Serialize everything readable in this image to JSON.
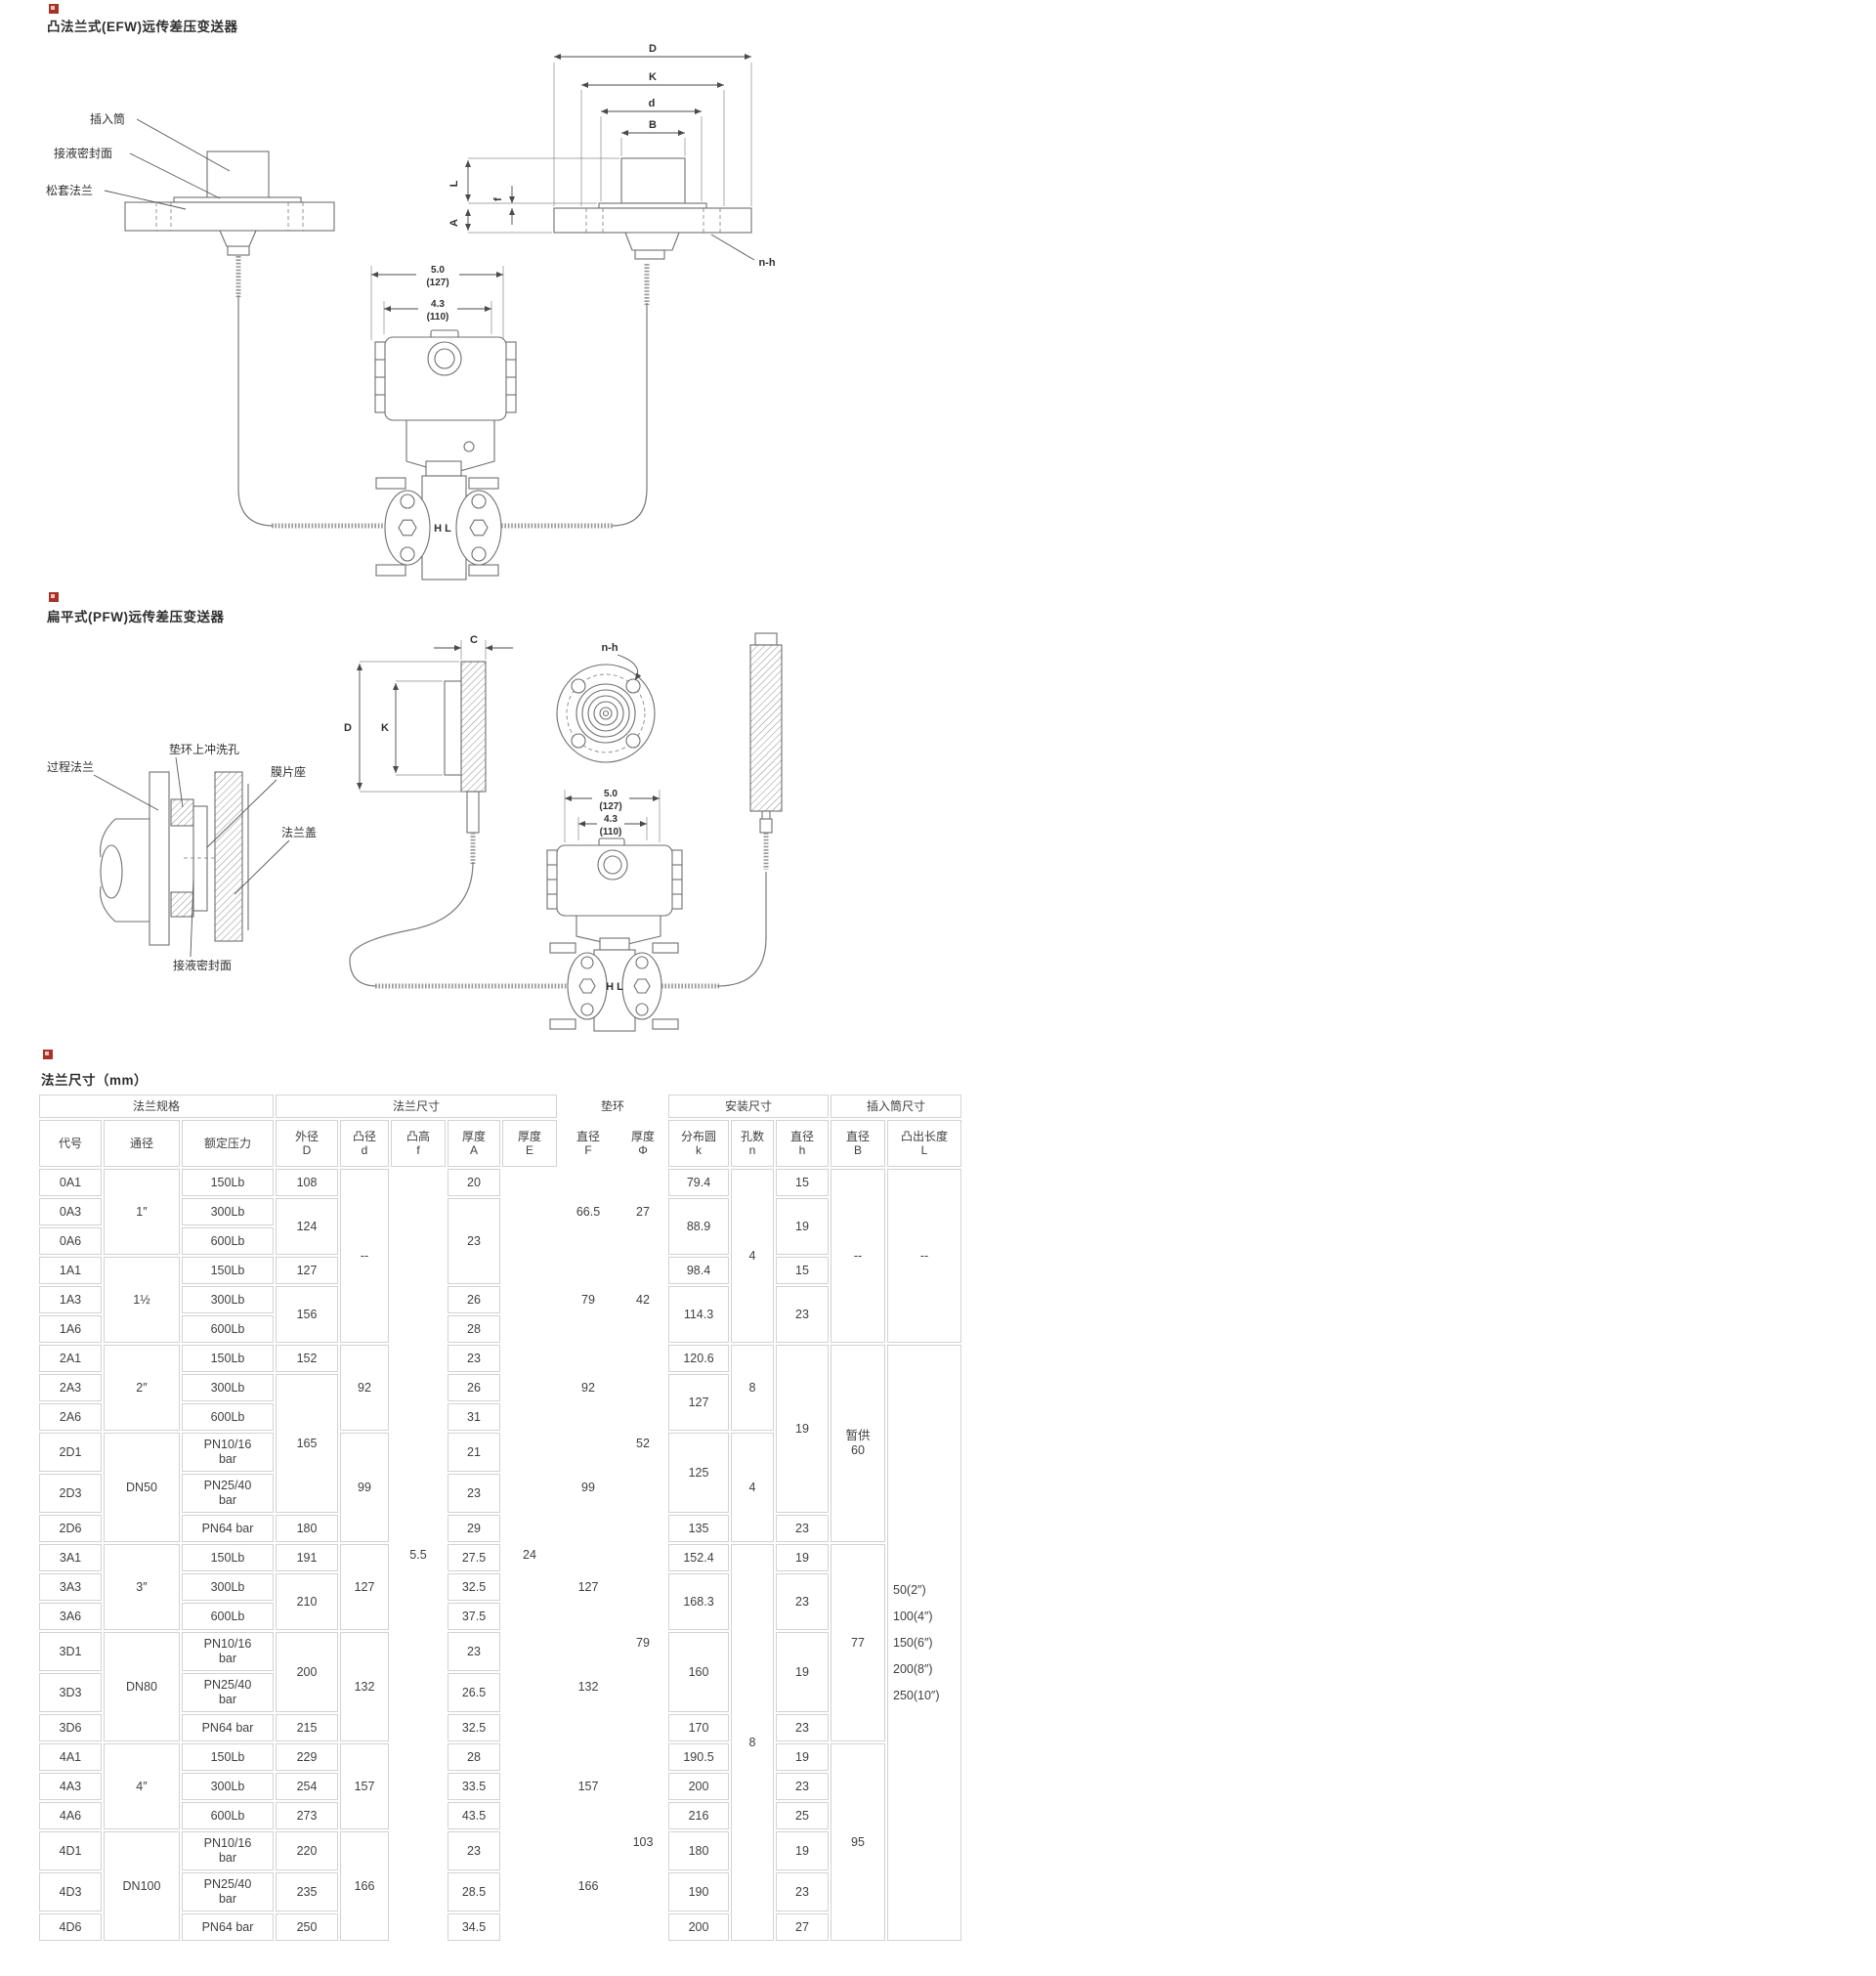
{
  "diagram_efw": {
    "title": "凸法兰式(EFW)远传差压变送器",
    "labels": {
      "insert_tube": "插入筒",
      "wetted_seal_face": "接液密封面",
      "loose_flange": "松套法兰",
      "nh": "n-h",
      "hl": "H L"
    },
    "dims": {
      "D": "D",
      "K": "K",
      "d": "d",
      "B": "B",
      "L": "L",
      "A": "A",
      "f": "f"
    },
    "w": {
      "w1": "5.0",
      "w1p": "(127)",
      "w2": "4.3",
      "w2p": "(110)"
    }
  },
  "diagram_pfw": {
    "title": "扁平式(PFW)远传差压变送器",
    "labels": {
      "process_flange": "过程法兰",
      "flush_hole": "垫环上冲洗孔",
      "diaphragm_seat": "膜片座",
      "flange_cover": "法兰盖",
      "wetted_seal_face": "接液密封面",
      "nh": "n-h",
      "hl": "H L"
    },
    "dims": {
      "C": "C",
      "D": "D",
      "K": "K"
    },
    "w": {
      "w1": "5.0",
      "w1p": "(127)",
      "w2": "4.3",
      "w2p": "(110)"
    }
  },
  "table": {
    "title": "法兰尺寸（mm）",
    "groups": [
      {
        "label": "法兰规格",
        "span": 3
      },
      {
        "label": "法兰尺寸",
        "span": 5
      },
      {
        "label": "垫环",
        "span": 2,
        "nb": true
      },
      {
        "label": "安装尺寸",
        "span": 3
      },
      {
        "label": "插入筒尺寸",
        "span": 2
      }
    ],
    "headers": [
      {
        "t": "代号"
      },
      {
        "t": "通径"
      },
      {
        "t": "额定压力"
      },
      {
        "t": "外径\nD"
      },
      {
        "t": "凸径\nd"
      },
      {
        "t": "凸高\nf"
      },
      {
        "t": "厚度\nA"
      },
      {
        "t": "厚度\nE"
      },
      {
        "t": "直径\nF",
        "nb": true
      },
      {
        "t": "厚度\nΦ",
        "nb": true
      },
      {
        "t": "分布圆\nk"
      },
      {
        "t": "孔数\nn"
      },
      {
        "t": "直径\nh"
      },
      {
        "t": "直径\nB"
      },
      {
        "t": "凸出长度\nL"
      }
    ],
    "body": [
      {
        "cells": [
          {
            "t": "0A1"
          },
          {
            "t": "1″",
            "rs": 3
          },
          {
            "t": "150Lb"
          },
          {
            "t": "108"
          },
          {
            "t": "--",
            "rs": 6
          },
          {
            "t": "5.5",
            "rs": 24,
            "nb": true
          },
          {
            "t": "20"
          },
          {
            "t": "24",
            "rs": 24,
            "nb": true
          },
          {
            "t": "66.5",
            "rs": 3,
            "nb": true
          },
          {
            "t": "27",
            "rs": 3,
            "nb": true
          },
          {
            "t": "79.4"
          },
          {
            "t": "4",
            "rs": 6
          },
          {
            "t": "15"
          },
          {
            "t": "--",
            "rs": 6
          },
          {
            "t": "--",
            "rs": 6
          }
        ]
      },
      {
        "cells": [
          {
            "t": "0A3"
          },
          {
            "t": "300Lb"
          },
          {
            "t": "124",
            "rs": 2
          },
          {
            "t": "23",
            "rs": 3
          },
          {
            "t": "88.9",
            "rs": 2
          },
          {
            "t": "19",
            "rs": 2
          }
        ]
      },
      {
        "cells": [
          {
            "t": "0A6"
          },
          {
            "t": "600Lb"
          }
        ]
      },
      {
        "cells": [
          {
            "t": "1A1"
          },
          {
            "t": "1½",
            "rs": 3
          },
          {
            "t": "150Lb"
          },
          {
            "t": "127"
          },
          {
            "t": "79",
            "rs": 3,
            "nb": true
          },
          {
            "t": "42",
            "rs": 3,
            "nb": true
          },
          {
            "t": "98.4"
          },
          {
            "t": "15"
          }
        ]
      },
      {
        "cells": [
          {
            "t": "1A3"
          },
          {
            "t": "300Lb"
          },
          {
            "t": "156",
            "rs": 2
          },
          {
            "t": "26"
          },
          {
            "t": "114.3",
            "rs": 2
          },
          {
            "t": "23",
            "rs": 2
          }
        ]
      },
      {
        "cells": [
          {
            "t": "1A6"
          },
          {
            "t": "600Lb"
          },
          {
            "t": "28"
          }
        ]
      },
      {
        "cells": [
          {
            "t": "2A1"
          },
          {
            "t": "2″",
            "rs": 3
          },
          {
            "t": "150Lb"
          },
          {
            "t": "152"
          },
          {
            "t": "92",
            "rs": 3
          },
          {
            "t": "23"
          },
          {
            "t": "92",
            "rs": 3,
            "nb": true
          },
          {
            "t": "52",
            "rs": 6,
            "nb": true
          },
          {
            "t": "120.6"
          },
          {
            "t": "8",
            "rs": 3
          },
          {
            "t": "19",
            "rs": 5
          },
          {
            "t": "暂供\n60",
            "rs": 6
          },
          {
            "t": "50(2″)\n100(4″)\n150(6″)\n200(8″)\n250(10″)",
            "rs": 18,
            "al": true
          }
        ]
      },
      {
        "cells": [
          {
            "t": "2A3"
          },
          {
            "t": "300Lb"
          },
          {
            "t": "165",
            "rs": 4
          },
          {
            "t": "26"
          },
          {
            "t": "127",
            "rs": 2
          }
        ]
      },
      {
        "cells": [
          {
            "t": "2A6"
          },
          {
            "t": "600Lb"
          },
          {
            "t": "31"
          }
        ]
      },
      {
        "tall": true,
        "cells": [
          {
            "t": "2D1"
          },
          {
            "t": "DN50",
            "rs": 3
          },
          {
            "t": "PN10/16\nbar"
          },
          {
            "t": "99",
            "rs": 3
          },
          {
            "t": "21"
          },
          {
            "t": "99",
            "rs": 3,
            "nb": true
          },
          {
            "t": "125",
            "rs": 2
          },
          {
            "t": "4",
            "rs": 3
          }
        ]
      },
      {
        "tall": true,
        "cells": [
          {
            "t": "2D3"
          },
          {
            "t": "PN25/40\nbar"
          },
          {
            "t": "23"
          }
        ]
      },
      {
        "cells": [
          {
            "t": "2D6"
          },
          {
            "t": "PN64 bar"
          },
          {
            "t": "180"
          },
          {
            "t": "29"
          },
          {
            "t": "135"
          },
          {
            "t": "23"
          }
        ]
      },
      {
        "cells": [
          {
            "t": "3A1"
          },
          {
            "t": "3″",
            "rs": 3
          },
          {
            "t": "150Lb"
          },
          {
            "t": "191"
          },
          {
            "t": "127",
            "rs": 3
          },
          {
            "t": "27.5"
          },
          {
            "t": "127",
            "rs": 3,
            "nb": true
          },
          {
            "t": "79",
            "rs": 6,
            "nb": true
          },
          {
            "t": "152.4"
          },
          {
            "t": "8",
            "rs": 12
          },
          {
            "t": "19"
          },
          {
            "t": "77",
            "rs": 6
          }
        ]
      },
      {
        "cells": [
          {
            "t": "3A3"
          },
          {
            "t": "300Lb"
          },
          {
            "t": "210",
            "rs": 2
          },
          {
            "t": "32.5"
          },
          {
            "t": "168.3",
            "rs": 2
          },
          {
            "t": "23",
            "rs": 2
          }
        ]
      },
      {
        "cells": [
          {
            "t": "3A6"
          },
          {
            "t": "600Lb"
          },
          {
            "t": "37.5"
          }
        ]
      },
      {
        "tall": true,
        "cells": [
          {
            "t": "3D1"
          },
          {
            "t": "DN80",
            "rs": 3
          },
          {
            "t": "PN10/16\nbar"
          },
          {
            "t": "200",
            "rs": 2
          },
          {
            "t": "132",
            "rs": 3
          },
          {
            "t": "23"
          },
          {
            "t": "132",
            "rs": 3,
            "nb": true
          },
          {
            "t": "160",
            "rs": 2
          },
          {
            "t": "19",
            "rs": 2
          }
        ]
      },
      {
        "tall": true,
        "cells": [
          {
            "t": "3D3"
          },
          {
            "t": "PN25/40\nbar"
          },
          {
            "t": "26.5"
          }
        ]
      },
      {
        "cells": [
          {
            "t": "3D6"
          },
          {
            "t": "PN64 bar"
          },
          {
            "t": "215"
          },
          {
            "t": "32.5"
          },
          {
            "t": "170"
          },
          {
            "t": "23"
          }
        ]
      },
      {
        "cells": [
          {
            "t": "4A1"
          },
          {
            "t": "4″",
            "rs": 3
          },
          {
            "t": "150Lb"
          },
          {
            "t": "229"
          },
          {
            "t": "157",
            "rs": 3
          },
          {
            "t": "28"
          },
          {
            "t": "157",
            "rs": 3,
            "nb": true
          },
          {
            "t": "103",
            "rs": 6,
            "nb": true
          },
          {
            "t": "190.5"
          },
          {
            "t": "19"
          },
          {
            "t": "95",
            "rs": 6
          }
        ]
      },
      {
        "cells": [
          {
            "t": "4A3"
          },
          {
            "t": "300Lb"
          },
          {
            "t": "254"
          },
          {
            "t": "33.5"
          },
          {
            "t": "200"
          },
          {
            "t": "23"
          }
        ]
      },
      {
        "cells": [
          {
            "t": "4A6"
          },
          {
            "t": "600Lb"
          },
          {
            "t": "273"
          },
          {
            "t": "43.5"
          },
          {
            "t": "216"
          },
          {
            "t": "25"
          }
        ]
      },
      {
        "tall": true,
        "cells": [
          {
            "t": "4D1"
          },
          {
            "t": "DN100",
            "rs": 3
          },
          {
            "t": "PN10/16\nbar"
          },
          {
            "t": "220"
          },
          {
            "t": "166",
            "rs": 3
          },
          {
            "t": "23"
          },
          {
            "t": "166",
            "rs": 3,
            "nb": true
          },
          {
            "t": "180"
          },
          {
            "t": "19"
          }
        ]
      },
      {
        "tall": true,
        "cells": [
          {
            "t": "4D3"
          },
          {
            "t": "PN25/40\nbar"
          },
          {
            "t": "235"
          },
          {
            "t": "28.5"
          },
          {
            "t": "190"
          },
          {
            "t": "23"
          }
        ]
      },
      {
        "cells": [
          {
            "t": "4D6"
          },
          {
            "t": "PN64 bar"
          },
          {
            "t": "250"
          },
          {
            "t": "34.5"
          },
          {
            "t": "200"
          },
          {
            "t": "27"
          }
        ]
      }
    ]
  }
}
